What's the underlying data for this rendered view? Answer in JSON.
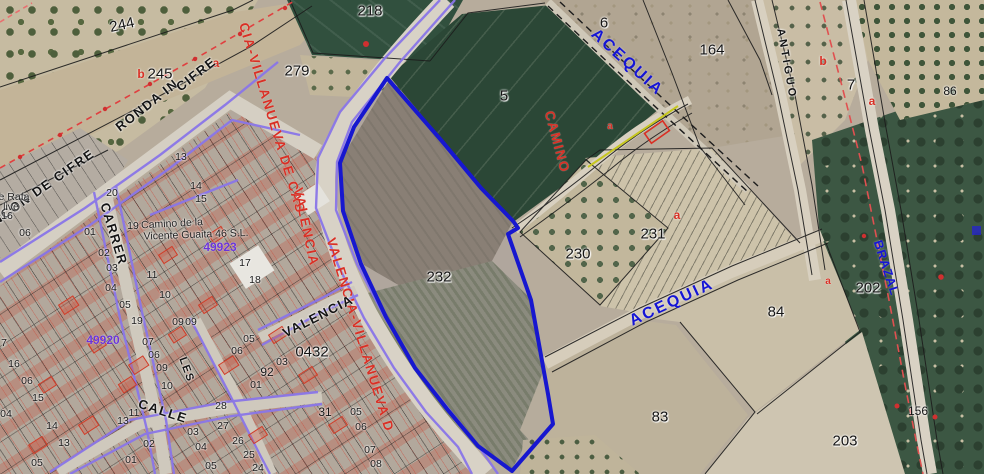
{
  "map": {
    "description": "Cadastral aerial map with subject parcel outlined in blue",
    "labels": [
      {
        "name": "parcel-number-244",
        "text": "244",
        "x": 122,
        "y": 25,
        "rot": -12,
        "cls": "num"
      },
      {
        "name": "subparcel-letter-b",
        "text": "b",
        "x": 141,
        "y": 74,
        "rot": 0,
        "cls": "red-letter"
      },
      {
        "name": "parcel-number-245",
        "text": "245",
        "x": 160,
        "y": 74,
        "rot": 0,
        "cls": "num"
      },
      {
        "name": "subparcel-letter-a",
        "text": "a",
        "x": 216,
        "y": 63,
        "rot": 0,
        "cls": "red-letter"
      },
      {
        "name": "parcel-number-218",
        "text": "218",
        "x": 370,
        "y": 11,
        "rot": 0,
        "cls": "num"
      },
      {
        "name": "parcel-number-279",
        "text": "279",
        "x": 297,
        "y": 71,
        "rot": 0,
        "cls": "num"
      },
      {
        "name": "parcel-number-6",
        "text": "6",
        "x": 604,
        "y": 23,
        "rot": 0,
        "cls": "num"
      },
      {
        "name": "parcel-number-164",
        "text": "164",
        "x": 712,
        "y": 50,
        "rot": 0,
        "cls": "num"
      },
      {
        "name": "parcel-number-5",
        "text": "5",
        "x": 504,
        "y": 96,
        "rot": 0,
        "cls": "num"
      },
      {
        "name": "subparcel-letter-b2",
        "text": "b",
        "x": 823,
        "y": 61,
        "rot": 0,
        "cls": "red-letter"
      },
      {
        "name": "parcel-number-7",
        "text": "7",
        "x": 851,
        "y": 85,
        "rot": 0,
        "cls": "num"
      },
      {
        "name": "subparcel-letter-a2",
        "text": "a",
        "x": 872,
        "y": 101,
        "rot": 0,
        "cls": "red-letter"
      },
      {
        "name": "parcel-number-86",
        "text": "86",
        "x": 950,
        "y": 91,
        "rot": 0,
        "cls": "num-sm"
      },
      {
        "name": "path-label-antiguo",
        "text": "ANTIGUO",
        "x": 786,
        "y": 64,
        "rot": 80,
        "cls": "street-bk sm sp2"
      },
      {
        "name": "acequia-label-top",
        "text": "ACEQUIA",
        "x": 627,
        "y": 63,
        "rot": 42,
        "cls": "blue-label"
      },
      {
        "name": "acequia-label-mid",
        "text": "ACEQUIA",
        "x": 672,
        "y": 303,
        "rot": -25,
        "cls": "blue-label"
      },
      {
        "name": "brazal-label",
        "text": "BRAZAL",
        "x": 886,
        "y": 268,
        "rot": 72,
        "cls": "blue-label blue-sm"
      },
      {
        "name": "camino-label-red",
        "text": "CAMINO",
        "x": 557,
        "y": 142,
        "rot": 75,
        "cls": "red-street sm"
      },
      {
        "name": "road-label-villanueva-1",
        "text": "CIA-VILLANUEVA DE CAS",
        "x": 272,
        "y": 118,
        "rot": 73,
        "cls": "red-street"
      },
      {
        "name": "road-label-valencia-red",
        "text": "VALENCIA",
        "x": 306,
        "y": 227,
        "rot": 78,
        "cls": "red-street"
      },
      {
        "name": "road-label-villanueva-2",
        "text": "VALENCIA-VILLANUEVA D",
        "x": 360,
        "y": 335,
        "rot": 73,
        "cls": "red-street"
      },
      {
        "name": "street-label-ronda",
        "text": "RONDA IN",
        "x": 147,
        "y": 105,
        "rot": -38,
        "cls": "street-bk"
      },
      {
        "name": "street-label-cifre",
        "text": "CIFRE",
        "x": 196,
        "y": 74,
        "rot": -38,
        "cls": "street-bk"
      },
      {
        "name": "street-label-rincon-de-cifre",
        "text": "NCON DE CIFRE",
        "x": 43,
        "y": 187,
        "rot": -35,
        "cls": "street-bk"
      },
      {
        "name": "street-label-carrer",
        "text": "CARRER",
        "x": 114,
        "y": 234,
        "rot": 73,
        "cls": "street-bk"
      },
      {
        "name": "street-label-calle",
        "text": "CALLE",
        "x": 163,
        "y": 411,
        "rot": 18,
        "cls": "street-bk"
      },
      {
        "name": "street-label-les",
        "text": "LES",
        "x": 186,
        "y": 370,
        "rot": 70,
        "cls": "street-bk sm"
      },
      {
        "name": "street-label-valencia",
        "text": "VALENCIA",
        "x": 318,
        "y": 316,
        "rot": -27,
        "cls": "street-bk"
      },
      {
        "name": "street-label-camino-de-la",
        "text": "Camino de la",
        "x": 172,
        "y": 224,
        "rot": -3,
        "cls": "small-bk"
      },
      {
        "name": "company-label-guaita",
        "text": "Vicente Guaita 46 S.L.",
        "x": 196,
        "y": 235,
        "rot": -2,
        "cls": "small-bk"
      },
      {
        "name": "street-fragment-rafa",
        "text": "e Rafa",
        "x": 14,
        "y": 197,
        "rot": 0,
        "cls": "small-bk"
      },
      {
        "name": "street-fragment-olive",
        "text": "live",
        "x": 11,
        "y": 207,
        "rot": 0,
        "cls": "small-bk"
      },
      {
        "name": "block-number-49923",
        "text": "49923",
        "x": 220,
        "y": 247,
        "rot": 0,
        "cls": "violet-num"
      },
      {
        "name": "block-number-49920",
        "text": "49920",
        "x": 103,
        "y": 340,
        "rot": 0,
        "cls": "violet-num"
      },
      {
        "name": "parcel-number-202",
        "text": "202",
        "x": 868,
        "y": 288,
        "rot": 0,
        "cls": "num"
      },
      {
        "name": "parcel-number-203",
        "text": "203",
        "x": 845,
        "y": 441,
        "rot": 0,
        "cls": "num"
      },
      {
        "name": "parcel-number-156",
        "text": "156",
        "x": 918,
        "y": 411,
        "rot": 0,
        "cls": "num-sm"
      },
      {
        "name": "parcel-number-84",
        "text": "84",
        "x": 776,
        "y": 312,
        "rot": 0,
        "cls": "num"
      },
      {
        "name": "parcel-number-83",
        "text": "83",
        "x": 660,
        "y": 417,
        "rot": 0,
        "cls": "num"
      },
      {
        "name": "parcel-number-232",
        "text": "232",
        "x": 439,
        "y": 277,
        "rot": 0,
        "cls": "num"
      },
      {
        "name": "parcel-number-230",
        "text": "230",
        "x": 578,
        "y": 254,
        "rot": 0,
        "cls": "num"
      },
      {
        "name": "parcel-number-231",
        "text": "231",
        "x": 653,
        "y": 234,
        "rot": 0,
        "cls": "num"
      },
      {
        "name": "subparcel-letter-a3",
        "text": "a",
        "x": 677,
        "y": 215,
        "rot": 0,
        "cls": "red-letter"
      },
      {
        "name": "subparcel-letter-a4",
        "text": "a",
        "x": 828,
        "y": 282,
        "rot": 0,
        "cls": "red-letter-sm"
      },
      {
        "name": "subparcel-letter-a5",
        "text": "a",
        "x": 610,
        "y": 127,
        "rot": 0,
        "cls": "red-letter-sm"
      },
      {
        "name": "house-number-0432",
        "text": "0432",
        "x": 312,
        "y": 352,
        "rot": 0,
        "cls": "num"
      },
      {
        "name": "house-number-92",
        "text": "92",
        "x": 267,
        "y": 372,
        "rot": 0,
        "cls": "num-sm"
      },
      {
        "name": "house-number-31",
        "text": "31",
        "x": 325,
        "y": 412,
        "rot": 0,
        "cls": "num-sm"
      },
      {
        "name": "house-number",
        "text": "13",
        "x": 181,
        "y": 157,
        "rot": 0,
        "cls": "num-xs"
      },
      {
        "name": "house-number",
        "text": "14",
        "x": 196,
        "y": 186,
        "rot": 0,
        "cls": "num-xs"
      },
      {
        "name": "house-number",
        "text": "15",
        "x": 201,
        "y": 199,
        "rot": 0,
        "cls": "num-xs"
      },
      {
        "name": "house-number",
        "text": "20",
        "x": 112,
        "y": 193,
        "rot": 0,
        "cls": "num-xs"
      },
      {
        "name": "house-number",
        "text": "19",
        "x": 133,
        "y": 226,
        "rot": 0,
        "cls": "num-xs"
      },
      {
        "name": "house-number",
        "text": "01",
        "x": 90,
        "y": 232,
        "rot": 0,
        "cls": "num-xs"
      },
      {
        "name": "house-number",
        "text": "02",
        "x": 104,
        "y": 253,
        "rot": 0,
        "cls": "num-xs"
      },
      {
        "name": "house-number",
        "text": "03",
        "x": 112,
        "y": 268,
        "rot": 0,
        "cls": "num-xs"
      },
      {
        "name": "house-number",
        "text": "04",
        "x": 111,
        "y": 288,
        "rot": 0,
        "cls": "num-xs"
      },
      {
        "name": "house-number",
        "text": "05",
        "x": 125,
        "y": 305,
        "rot": 0,
        "cls": "num-xs"
      },
      {
        "name": "house-number",
        "text": "11",
        "x": 152,
        "y": 275,
        "rot": 0,
        "cls": "num-xs"
      },
      {
        "name": "house-number",
        "text": "10",
        "x": 165,
        "y": 295,
        "rot": 0,
        "cls": "num-xs"
      },
      {
        "name": "house-number",
        "text": "17",
        "x": 245,
        "y": 263,
        "rot": 0,
        "cls": "num-xs"
      },
      {
        "name": "house-number",
        "text": "18",
        "x": 255,
        "y": 280,
        "rot": 0,
        "cls": "num-xs"
      },
      {
        "name": "house-number",
        "text": "16",
        "x": 7,
        "y": 216,
        "rot": 0,
        "cls": "num-xs"
      },
      {
        "name": "house-number",
        "text": "06",
        "x": 25,
        "y": 233,
        "rot": 0,
        "cls": "num-xs"
      },
      {
        "name": "house-number",
        "text": "19",
        "x": 137,
        "y": 321,
        "rot": 0,
        "cls": "num-xs"
      },
      {
        "name": "house-number",
        "text": "09",
        "x": 178,
        "y": 322,
        "rot": 0,
        "cls": "num-xs"
      },
      {
        "name": "house-number",
        "text": "09",
        "x": 191,
        "y": 322,
        "rot": 0,
        "cls": "num-xs"
      },
      {
        "name": "house-number",
        "text": "07",
        "x": 148,
        "y": 342,
        "rot": 0,
        "cls": "num-xs"
      },
      {
        "name": "house-number",
        "text": "06",
        "x": 154,
        "y": 355,
        "rot": 0,
        "cls": "num-xs"
      },
      {
        "name": "house-number",
        "text": "09",
        "x": 162,
        "y": 368,
        "rot": 0,
        "cls": "num-xs"
      },
      {
        "name": "house-number",
        "text": "10",
        "x": 167,
        "y": 386,
        "rot": 0,
        "cls": "num-xs"
      },
      {
        "name": "house-number",
        "text": "11",
        "x": 134,
        "y": 413,
        "rot": 0,
        "cls": "num-xs"
      },
      {
        "name": "house-number",
        "text": "13",
        "x": 123,
        "y": 421,
        "rot": 0,
        "cls": "num-xs"
      },
      {
        "name": "house-number",
        "text": "16",
        "x": 14,
        "y": 364,
        "rot": 0,
        "cls": "num-xs"
      },
      {
        "name": "house-number",
        "text": "06",
        "x": 27,
        "y": 381,
        "rot": 0,
        "cls": "num-xs"
      },
      {
        "name": "house-number",
        "text": "15",
        "x": 38,
        "y": 398,
        "rot": 0,
        "cls": "num-xs"
      },
      {
        "name": "house-number",
        "text": "04",
        "x": 6,
        "y": 414,
        "rot": 0,
        "cls": "num-xs"
      },
      {
        "name": "house-number",
        "text": "14",
        "x": 52,
        "y": 426,
        "rot": 0,
        "cls": "num-xs"
      },
      {
        "name": "house-number",
        "text": "13",
        "x": 64,
        "y": 443,
        "rot": 0,
        "cls": "num-xs"
      },
      {
        "name": "house-number",
        "text": "05",
        "x": 37,
        "y": 463,
        "rot": 0,
        "cls": "num-xs"
      },
      {
        "name": "house-number",
        "text": "7",
        "x": 4,
        "y": 343,
        "rot": 0,
        "cls": "num-xs"
      },
      {
        "name": "house-number",
        "text": "28",
        "x": 221,
        "y": 406,
        "rot": 0,
        "cls": "num-xs"
      },
      {
        "name": "house-number",
        "text": "27",
        "x": 223,
        "y": 426,
        "rot": 0,
        "cls": "num-xs"
      },
      {
        "name": "house-number",
        "text": "26",
        "x": 238,
        "y": 441,
        "rot": 0,
        "cls": "num-xs"
      },
      {
        "name": "house-number",
        "text": "25",
        "x": 249,
        "y": 455,
        "rot": 0,
        "cls": "num-xs"
      },
      {
        "name": "house-number",
        "text": "24",
        "x": 258,
        "y": 468,
        "rot": 0,
        "cls": "num-xs"
      },
      {
        "name": "house-number",
        "text": "03",
        "x": 193,
        "y": 432,
        "rot": 0,
        "cls": "num-xs"
      },
      {
        "name": "house-number",
        "text": "04",
        "x": 201,
        "y": 447,
        "rot": 0,
        "cls": "num-xs"
      },
      {
        "name": "house-number",
        "text": "05",
        "x": 211,
        "y": 466,
        "rot": 0,
        "cls": "num-xs"
      },
      {
        "name": "house-number",
        "text": "01",
        "x": 131,
        "y": 460,
        "rot": 0,
        "cls": "num-xs"
      },
      {
        "name": "house-number",
        "text": "02",
        "x": 149,
        "y": 444,
        "rot": 0,
        "cls": "num-xs"
      },
      {
        "name": "house-number",
        "text": "01",
        "x": 256,
        "y": 385,
        "rot": 0,
        "cls": "num-xs"
      },
      {
        "name": "house-number",
        "text": "05",
        "x": 249,
        "y": 339,
        "rot": 0,
        "cls": "num-xs"
      },
      {
        "name": "house-number",
        "text": "06",
        "x": 237,
        "y": 351,
        "rot": 0,
        "cls": "num-xs"
      },
      {
        "name": "house-number",
        "text": "03",
        "x": 282,
        "y": 362,
        "rot": 0,
        "cls": "num-xs"
      },
      {
        "name": "house-number",
        "text": "05",
        "x": 356,
        "y": 412,
        "rot": 0,
        "cls": "num-xs"
      },
      {
        "name": "house-number",
        "text": "06",
        "x": 361,
        "y": 427,
        "rot": 0,
        "cls": "num-xs"
      },
      {
        "name": "house-number",
        "text": "07",
        "x": 370,
        "y": 450,
        "rot": 0,
        "cls": "num-xs"
      },
      {
        "name": "house-number",
        "text": "08",
        "x": 376,
        "y": 464,
        "rot": 0,
        "cls": "num-xs"
      }
    ]
  },
  "colors": {
    "red": "#d93025",
    "blue": "#1515d6",
    "violet": "#8a76e8",
    "subject-parcel-blue": "#1717cf",
    "ink": "#1c1c1c"
  }
}
